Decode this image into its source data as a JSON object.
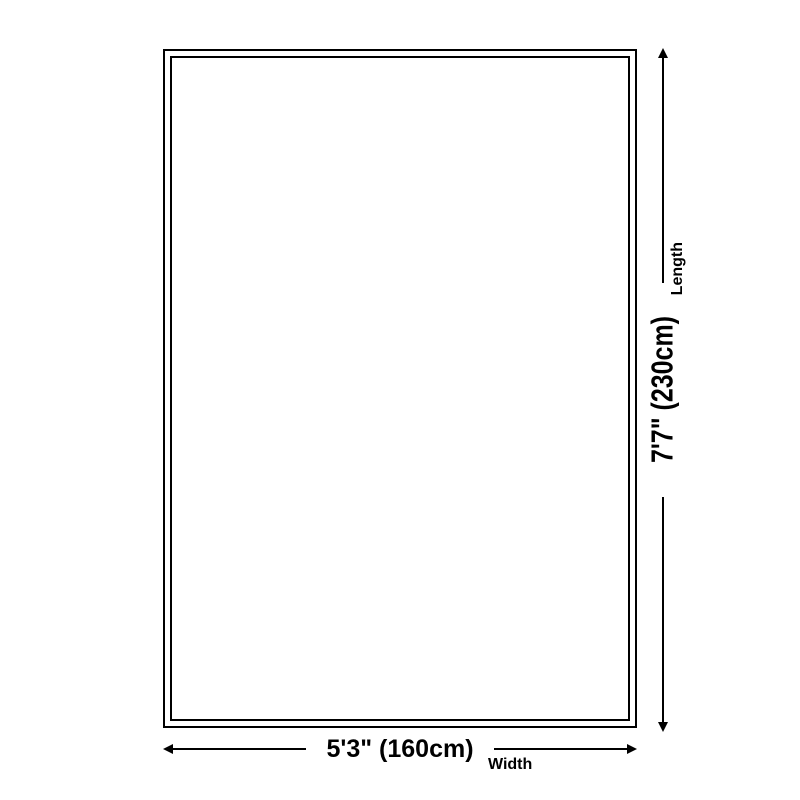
{
  "diagram": {
    "kind": "product-size-diagram",
    "colors": {
      "background": "#ffffff",
      "line": "#000000",
      "text": "#000000"
    },
    "rug": {
      "shape": "rectangle",
      "border_style": "double"
    },
    "length": {
      "value": "7'7\" (230cm)",
      "label": "Length"
    },
    "width": {
      "value": "5'3\" (160cm)",
      "label": "Width"
    }
  }
}
